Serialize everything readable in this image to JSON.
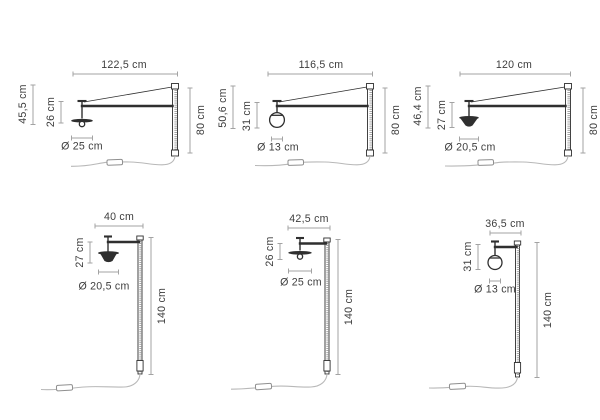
{
  "colors": {
    "background": "#ffffff",
    "structure_line": "#2f2f2f",
    "dimension_line": "#a3a3a3",
    "label_text": "#3d3d3d",
    "cord_line": "#b8b8b8"
  },
  "diagrams": [
    {
      "id": "top-left",
      "variant": "long-arm-wall-lamp-flat-disc-shade",
      "labels": {
        "width": "122,5 cm",
        "height": "80 cm",
        "outer_drop": "45,5 cm",
        "inner_drop": "26 cm",
        "diameter": "Ø 25 cm"
      }
    },
    {
      "id": "top-middle",
      "variant": "long-arm-wall-lamp-sphere-shade",
      "labels": {
        "width": "116,5 cm",
        "height": "80 cm",
        "outer_drop": "50,6 cm",
        "inner_drop": "31 cm",
        "diameter": "Ø 13 cm"
      }
    },
    {
      "id": "top-right",
      "variant": "long-arm-wall-lamp-cone-shade",
      "labels": {
        "width": "120 cm",
        "height": "80 cm",
        "outer_drop": "46,4 cm",
        "inner_drop": "27 cm",
        "diameter": "Ø 20,5 cm"
      }
    },
    {
      "id": "bottom-left",
      "variant": "short-arm-wall-lamp-cone-shade",
      "labels": {
        "width": "40 cm",
        "height": "140 cm",
        "inner_drop": "27 cm",
        "diameter": "Ø 20,5 cm"
      }
    },
    {
      "id": "bottom-middle",
      "variant": "short-arm-wall-lamp-flat-disc-shade",
      "labels": {
        "width": "42,5 cm",
        "height": "140 cm",
        "inner_drop": "26 cm",
        "diameter": "Ø 25 cm"
      }
    },
    {
      "id": "bottom-right",
      "variant": "short-arm-wall-lamp-sphere-shade",
      "labels": {
        "width": "36,5 cm",
        "height": "140 cm",
        "inner_drop": "31 cm",
        "diameter": "Ø 13 cm"
      }
    }
  ]
}
